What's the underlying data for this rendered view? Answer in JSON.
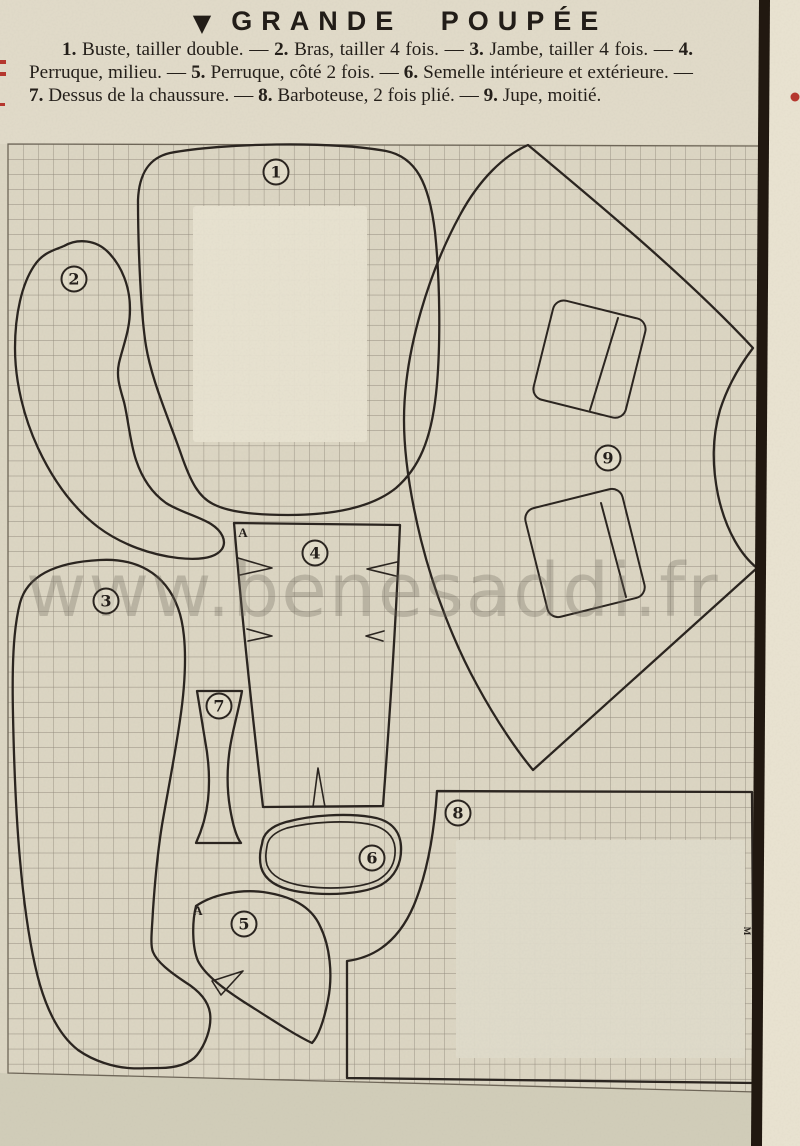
{
  "document": {
    "title": {
      "marker": "▼",
      "text": "GRANDE POUPÉE"
    },
    "legend": {
      "separator": " — ",
      "items": [
        {
          "num": "1.",
          "text": "Buste, tailler double."
        },
        {
          "num": "2.",
          "text": "Bras, tailler 4 fois."
        },
        {
          "num": "3.",
          "text": "Jambe, tailler 4 fois."
        },
        {
          "num": "4.",
          "text": "Perruque, milieu."
        },
        {
          "num": "5.",
          "text": "Perruque, côté 2 fois."
        },
        {
          "num": "6.",
          "text": "Semelle intérieure et extérieure."
        },
        {
          "num": "7.",
          "text": "Dessus de la chaussure."
        },
        {
          "num": "8.",
          "text": "Barboteuse, 2 fois plié."
        },
        {
          "num": "9.",
          "text": "Jupe, moitié."
        }
      ]
    },
    "watermark": "www.benesaddi.fr",
    "pieces": [
      {
        "number": "1",
        "name": "Buste",
        "cx": 276,
        "cy": 172
      },
      {
        "number": "2",
        "name": "Bras",
        "cx": 74,
        "cy": 279
      },
      {
        "number": "3",
        "name": "Jambe",
        "cx": 106,
        "cy": 601
      },
      {
        "number": "4",
        "name": "Perruque milieu",
        "cx": 315,
        "cy": 553
      },
      {
        "number": "5",
        "name": "Perruque côté",
        "cx": 244,
        "cy": 924
      },
      {
        "number": "6",
        "name": "Semelle",
        "cx": 372,
        "cy": 858
      },
      {
        "number": "7",
        "name": "Dessus de la chaussure",
        "cx": 219,
        "cy": 706
      },
      {
        "number": "8",
        "name": "Barboteuse",
        "cx": 458,
        "cy": 813
      },
      {
        "number": "9",
        "name": "Jupe",
        "cx": 608,
        "cy": 458
      }
    ],
    "grid_markers": [
      {
        "text": "A",
        "x": 243,
        "y": 533,
        "rotate": 0
      },
      {
        "text": "A",
        "x": 198,
        "y": 911,
        "rotate": 0
      },
      {
        "text": "M",
        "x": 747,
        "y": 931,
        "rotate": 90
      }
    ],
    "colors": {
      "paper": "#ddd7c4",
      "paper_margin": "#eae4d2",
      "grid_line": "#7e766a",
      "ink": "#272220",
      "outline": "#2b2520",
      "page_edge_band": "#211810",
      "red_mark": "#b5372e",
      "wash": "#e8e3d1",
      "watermark_color": "#6e685c"
    }
  }
}
